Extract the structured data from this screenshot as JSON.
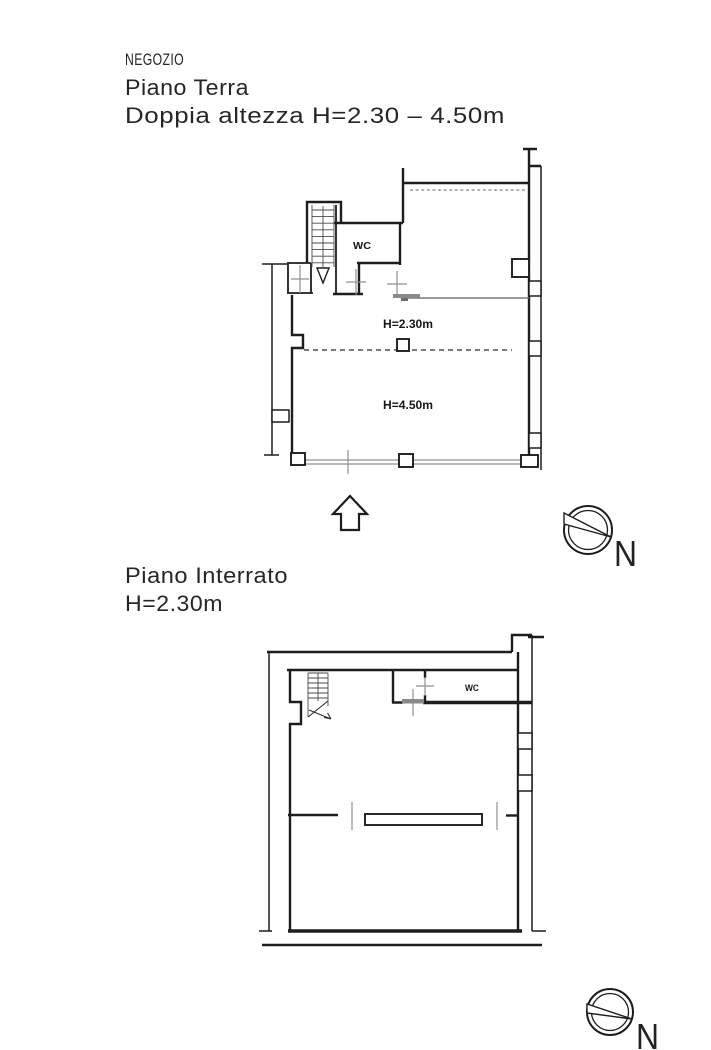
{
  "sheet": {
    "background": "#ffffff",
    "ink": "#1d1d1d",
    "gray": "#8f8f8f"
  },
  "header": {
    "line1": "NEGOZIO",
    "line2": "Piano Terra",
    "line3": "Doppia altezza H=2.30 – 4.50m"
  },
  "ground_floor": {
    "wc_label": "WC",
    "low_zone_label": "H=2.30m",
    "high_zone_label": "H=4.50m"
  },
  "basement": {
    "title": "Piano Interrato",
    "height_label": "H=2.30m",
    "wc_label": "WC"
  },
  "north": {
    "letter": "N"
  }
}
